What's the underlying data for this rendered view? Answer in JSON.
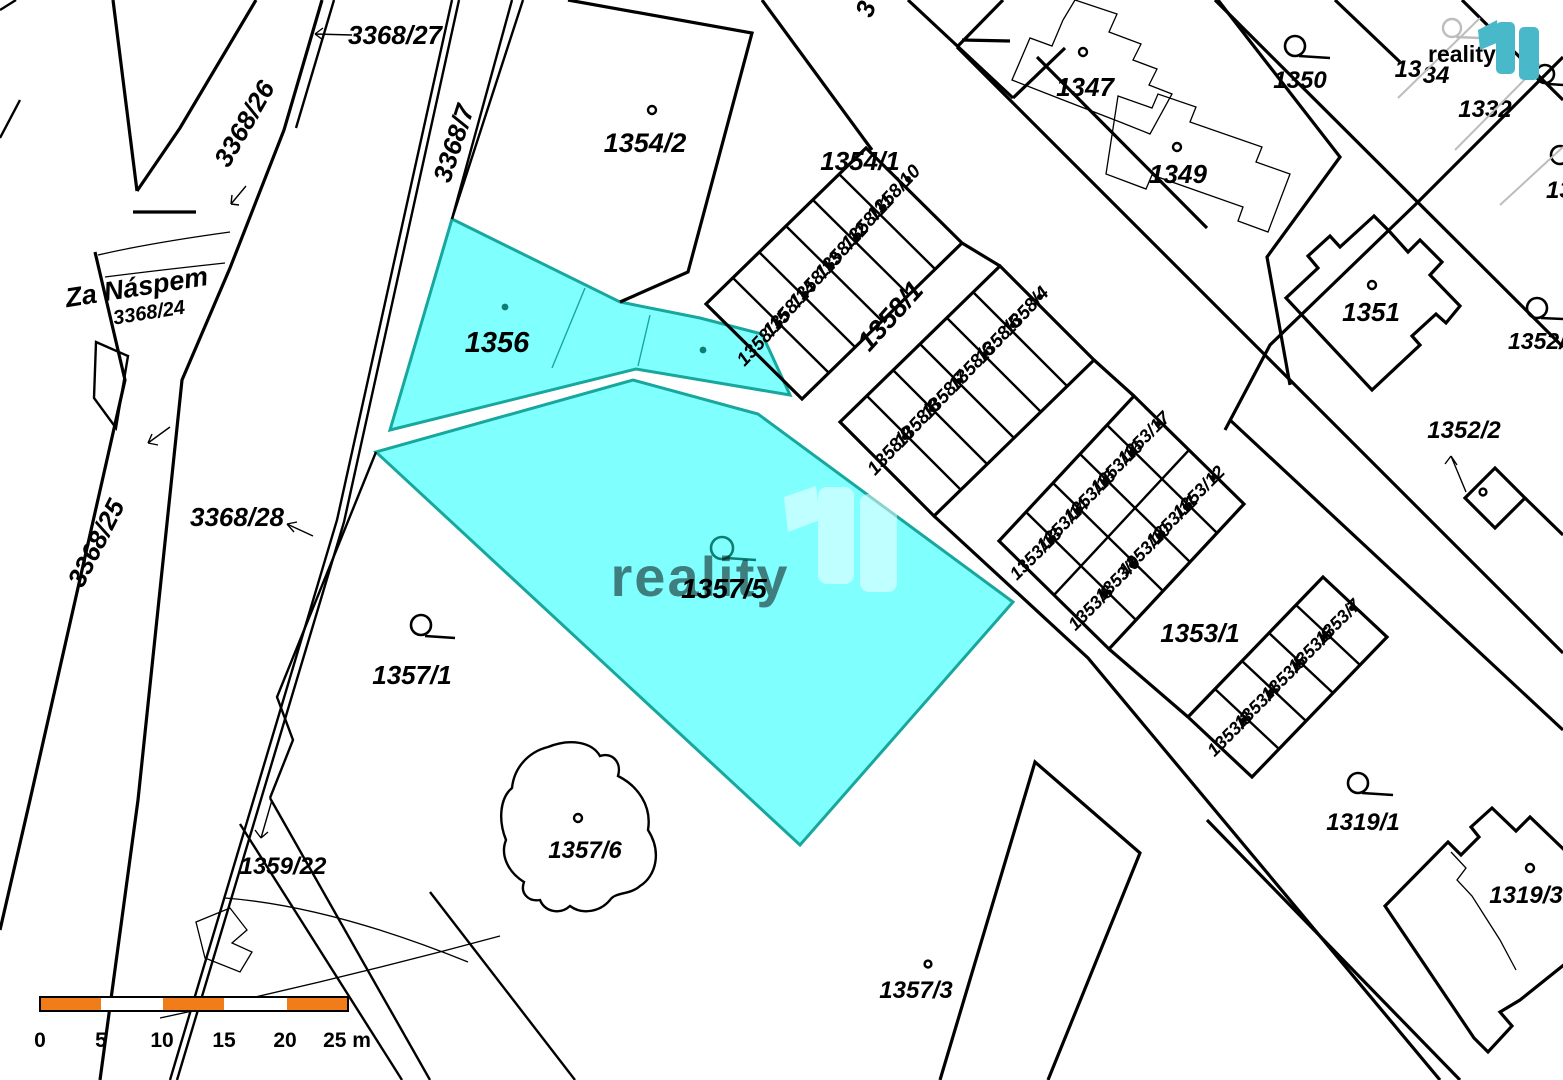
{
  "map": {
    "street_name": "Za Náspem",
    "watermark": {
      "text": "reality"
    },
    "logo": {
      "text": "reality"
    },
    "scale_bar": {
      "labels": [
        "0",
        "5",
        "10",
        "15",
        "20",
        "25 m"
      ]
    },
    "colors": {
      "highlight_fill": "#80ffff",
      "highlight_stroke": "#17a79d",
      "highlight_text": "#0e7d72",
      "scale_orange": "#f07d1a",
      "logo_teal": "#49b9c9",
      "logo_text_color": "#3c3c3c",
      "line_black": "#000000",
      "watermark_grey": "#b9b9b9"
    },
    "labels": {
      "p3368_27": "3368/27",
      "p3368_26": "3368/26",
      "p3368_7": "3368/7",
      "p3368_24": "3368/24",
      "p3368_25": "3368/25",
      "p3368_28": "3368/28",
      "edge_cut_3": "3",
      "p1354_2": "1354/2",
      "p1354_1": "1354/1",
      "p1356": "1356",
      "p1357_5": "1357/5",
      "p1357_1": "1357/1",
      "p1357_6": "1357/6",
      "p1357_3": "1357/3",
      "p1359_22": "1359/22",
      "p1358_1": "1358/1",
      "p1358_4": "1358/4",
      "p1358_5": "1358/5",
      "p1358_6": "1358/6",
      "p1358_7": "1358/7",
      "p1358_8": "1358/8",
      "p1358_9": "1358/9",
      "p1358_10": "1358/10",
      "p1358_11": "1358/11",
      "p1358_12": "1358/12",
      "p1358_13": "1358/13",
      "p1358_14": "1358/14",
      "p1358_15": "1358/15",
      "p1347": "1347",
      "p1349": "1349",
      "p1350": "1350",
      "p1334_black": "13",
      "p1334_grey": "34",
      "p1332": "1332",
      "p13_cut": "13",
      "p1351": "1351",
      "p1352_cut": "1352/",
      "p1352_2": "1352/2",
      "p1353_1": "1353/1",
      "p1353_3": "1353/3",
      "p1353_4": "1353/4",
      "p1353_5": "1353/5",
      "p1353_6": "1353/6",
      "p1353_7": "1353/7",
      "p1353_8": "1353/8",
      "p1353_9": "1353/9",
      "p1353_10": "1353/10",
      "p1353_11": "1353/11",
      "p1353_12": "1353/12",
      "p1353_13": "1353/13",
      "p1353_14": "1353/14",
      "p1353_15": "1353/15",
      "p1353_16": "1353/16",
      "p1353_17": "1353/17",
      "p1319_1": "1319/1",
      "p1319_3": "1319/3"
    }
  }
}
